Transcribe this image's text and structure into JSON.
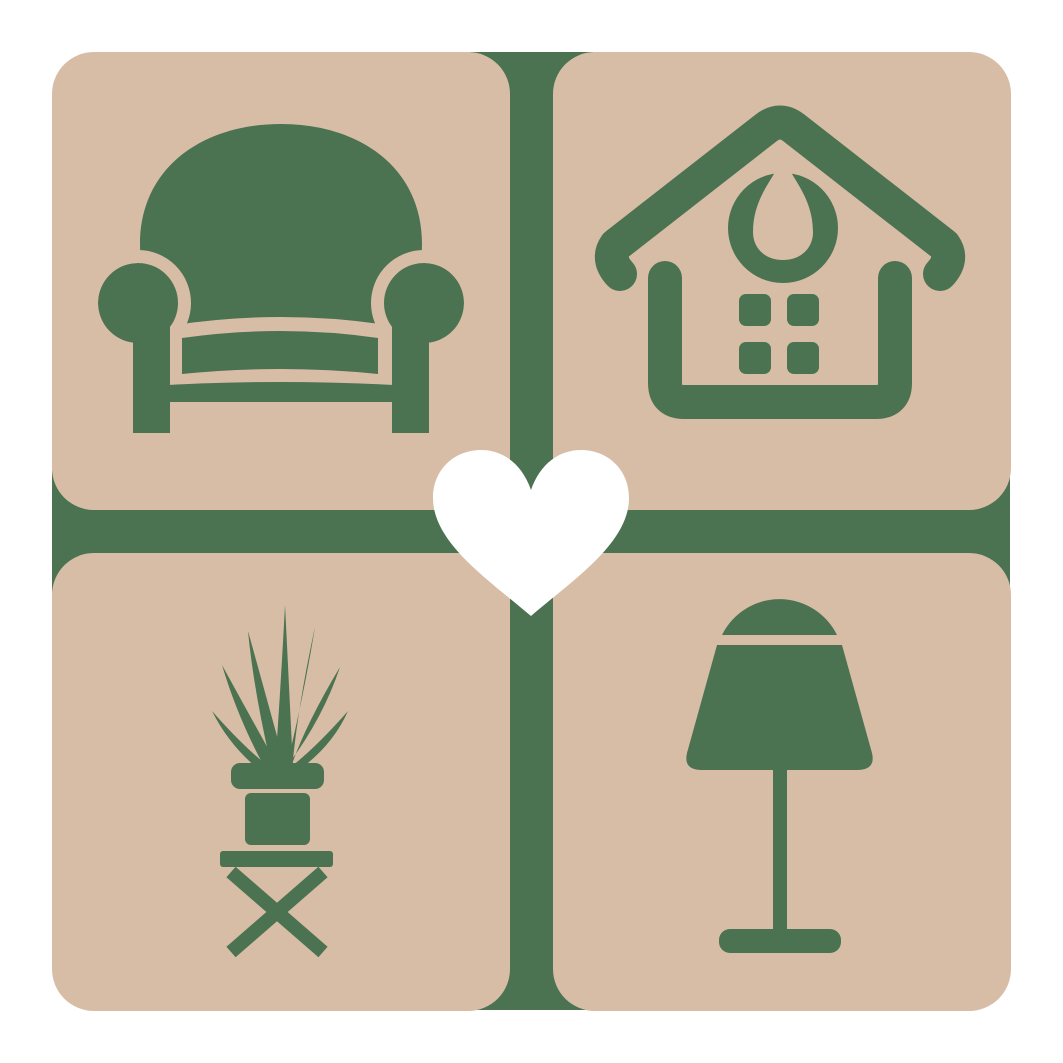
{
  "colors": {
    "background": "#ffffff",
    "tile_beige": "#d8bda6",
    "icon_green": "#4b7351",
    "heart_white": "#ffffff"
  },
  "logo": {
    "grid": {
      "rows": 2,
      "cols": 2,
      "tile_count": 4,
      "divider": "green-cross"
    },
    "tiles": [
      {
        "position": "top-left",
        "icon": "armchair-icon",
        "subject": "armchair"
      },
      {
        "position": "top-right",
        "icon": "house-icon",
        "subject": "house with four-pane window and droplet ornament"
      },
      {
        "position": "bottom-left",
        "icon": "potted-plant-icon",
        "subject": "spiky potted plant on cross-legged stool"
      },
      {
        "position": "bottom-right",
        "icon": "table-lamp-icon",
        "subject": "table lamp with shade"
      }
    ],
    "center_icon": "heart-icon"
  }
}
